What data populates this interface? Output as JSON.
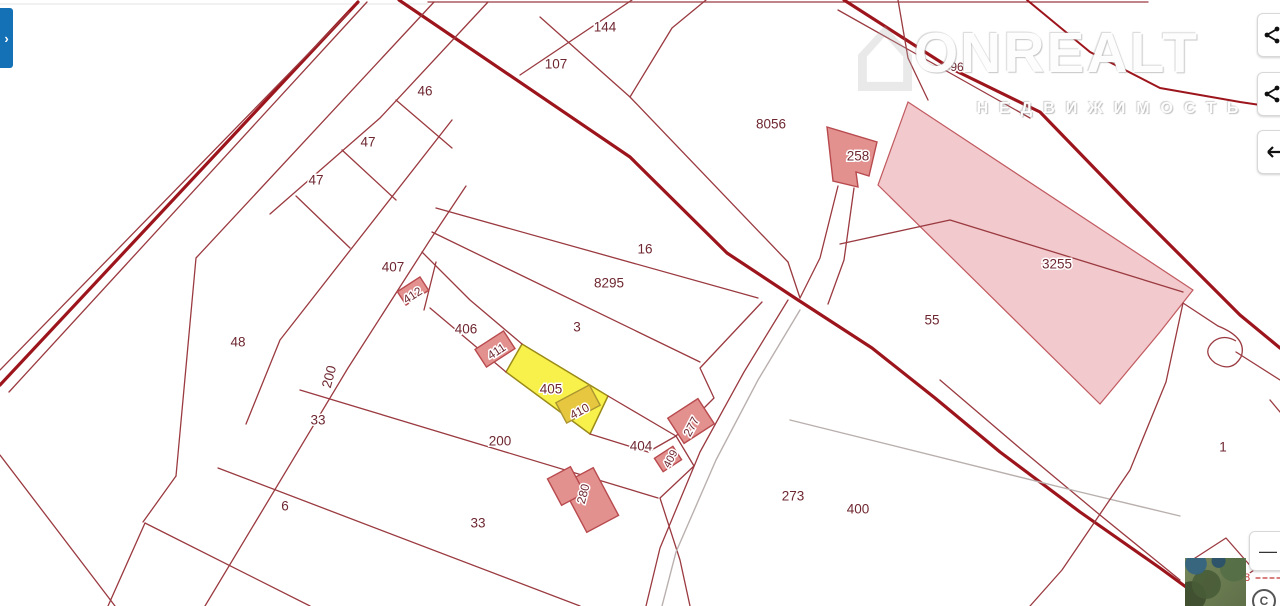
{
  "watermark": {
    "title": "ONREALT",
    "subtitle": "НЕДВИЖИМОСТЬ",
    "house_glyph": "⌂"
  },
  "panel_tab": {
    "glyph": "›"
  },
  "controls": {
    "zoom_out_glyph": "—",
    "side_buttons": [
      {
        "icon": "share-icon"
      },
      {
        "icon": "share-icon"
      },
      {
        "icon": "arrow-left-icon"
      }
    ]
  },
  "attribution": {
    "symbol": "C"
  },
  "map": {
    "colors": {
      "background": "#ffffff",
      "parcel_line": "#9a3a40",
      "road": "#9d151c",
      "gray_line": "#b9b0ae",
      "light_line": "#e3e3e3",
      "label": "#6e2730",
      "label_halo": "#ffffff",
      "building_fill": "#e2918f",
      "building_stroke": "#b84a4e",
      "zone_pink_fill": "#f2c9cc",
      "zone_pink_stroke": "#c05a60",
      "highlight_fill": "#f8f14b",
      "highlight_stroke": "#9a8a18",
      "highlight_building_fill": "#e6c73f",
      "highlight_building_stroke": "#ab9530",
      "dash_red": "#c23434"
    },
    "styles": {
      "road": {
        "c": "#9d151c",
        "w": 3.2
      },
      "road2": {
        "c": "#9d151c",
        "w": 2
      },
      "line": {
        "c": "#9a3a40",
        "w": 1.3
      },
      "gray": {
        "c": "#b9b0ae",
        "w": 1.4
      },
      "light": {
        "c": "#e3e3e3",
        "w": 1
      },
      "dash": {
        "c": "#c23434",
        "w": 1.2,
        "d": "4,3"
      }
    },
    "zones": [
      {
        "name": "zone-3255",
        "pts": [
          [
            908,
            102
          ],
          [
            1193,
            290
          ],
          [
            1160,
            332
          ],
          [
            1100,
            404
          ],
          [
            878,
            185
          ]
        ],
        "fill": "#f2c9cc",
        "stroke": "#c05a60",
        "sw": 1.2
      },
      {
        "name": "parcel-405-highlight",
        "pts": [
          [
            522,
            344
          ],
          [
            608,
            396
          ],
          [
            590,
            434
          ],
          [
            506,
            372
          ]
        ],
        "fill": "#f8f14b",
        "stroke": "#9a8a18",
        "sw": 1.5,
        "interactable": true
      }
    ],
    "lines": [
      {
        "k": "light",
        "pts": [
          [
            0,
            4
          ],
          [
            428,
            4
          ]
        ]
      },
      {
        "k": "line",
        "pts": [
          [
            428,
            2
          ],
          [
            1148,
            2
          ]
        ]
      },
      {
        "k": "road",
        "pts": [
          [
            358,
            2
          ],
          [
            0,
            385
          ]
        ]
      },
      {
        "k": "line",
        "pts": [
          [
            367,
            2
          ],
          [
            9,
            392
          ]
        ]
      },
      {
        "k": "line",
        "pts": [
          [
            349,
            12
          ],
          [
            0,
            370
          ]
        ]
      },
      {
        "k": "road",
        "pts": [
          [
            399,
            0
          ],
          [
            630,
            157
          ],
          [
            727,
            253
          ],
          [
            795,
            298
          ],
          [
            872,
            348
          ],
          [
            935,
            398
          ],
          [
            1000,
            452
          ],
          [
            1080,
            512
          ],
          [
            1160,
            568
          ],
          [
            1212,
            606
          ]
        ]
      },
      {
        "k": "road",
        "pts": [
          [
            844,
            0
          ],
          [
            950,
            68
          ],
          [
            1040,
            112
          ],
          [
            1130,
            205
          ],
          [
            1240,
            315
          ],
          [
            1280,
            348
          ]
        ]
      },
      {
        "k": "line",
        "pts": [
          [
            838,
            10
          ],
          [
            1030,
            118
          ]
        ]
      },
      {
        "k": "road2",
        "pts": [
          [
            1027,
            0
          ],
          [
            1090,
            52
          ],
          [
            1160,
            88
          ],
          [
            1240,
            102
          ],
          [
            1280,
            108
          ]
        ]
      },
      {
        "k": "line",
        "pts": [
          [
            434,
            2
          ],
          [
            196,
            258
          ],
          [
            176,
            476
          ]
        ]
      },
      {
        "k": "line",
        "pts": [
          [
            176,
            476
          ],
          [
            143,
            522
          ]
        ]
      },
      {
        "k": "line",
        "pts": [
          [
            466,
            186
          ],
          [
            430,
            240
          ],
          [
            348,
            368
          ],
          [
            205,
            606
          ]
        ]
      },
      {
        "k": "line",
        "pts": [
          [
            452,
            120
          ],
          [
            280,
            340
          ],
          [
            246,
            424
          ]
        ]
      },
      {
        "k": "line",
        "pts": [
          [
            488,
            2
          ],
          [
            380,
            118
          ],
          [
            270,
            214
          ]
        ]
      },
      {
        "k": "line",
        "pts": [
          [
            632,
            0
          ],
          [
            520,
            75
          ]
        ]
      },
      {
        "k": "line",
        "pts": [
          [
            540,
            17
          ],
          [
            630,
            97
          ],
          [
            672,
            28
          ],
          [
            706,
            0
          ]
        ]
      },
      {
        "k": "line",
        "pts": [
          [
            630,
            97
          ],
          [
            788,
            262
          ]
        ]
      },
      {
        "k": "line",
        "pts": [
          [
            788,
            262
          ],
          [
            800,
            298
          ]
        ]
      },
      {
        "k": "line",
        "pts": [
          [
            838,
            186
          ],
          [
            820,
            258
          ],
          [
            800,
            298
          ]
        ]
      },
      {
        "k": "line",
        "pts": [
          [
            854,
            188
          ],
          [
            844,
            260
          ],
          [
            828,
            304
          ]
        ]
      },
      {
        "k": "line",
        "pts": [
          [
            898,
            0
          ],
          [
            908,
            58
          ],
          [
            928,
            100
          ]
        ]
      },
      {
        "k": "line",
        "pts": [
          [
            840,
            244
          ],
          [
            950,
            220
          ],
          [
            1183,
            292
          ]
        ]
      },
      {
        "k": "line",
        "pts": [
          [
            940,
            380
          ],
          [
            1022,
            450
          ],
          [
            1100,
            515
          ],
          [
            1180,
            580
          ]
        ]
      },
      {
        "k": "line",
        "pts": [
          [
            762,
            302
          ],
          [
            700,
            368
          ],
          [
            714,
            398
          ],
          [
            676,
            436
          ],
          [
            694,
            466
          ],
          [
            660,
            498
          ],
          [
            680,
            560
          ],
          [
            690,
            606
          ]
        ]
      },
      {
        "k": "line",
        "pts": [
          [
            788,
            300
          ],
          [
            744,
            372
          ],
          [
            700,
            452
          ],
          [
            660,
            548
          ],
          [
            646,
            606
          ]
        ]
      },
      {
        "k": "gray",
        "pts": [
          [
            800,
            310
          ],
          [
            758,
            380
          ],
          [
            716,
            460
          ],
          [
            676,
            552
          ],
          [
            662,
            606
          ]
        ]
      },
      {
        "k": "gray",
        "pts": [
          [
            790,
            420
          ],
          [
            1080,
            492
          ],
          [
            1180,
            516
          ]
        ]
      },
      {
        "k": "line",
        "pts": [
          [
            436,
            208
          ],
          [
            758,
            298
          ]
        ]
      },
      {
        "k": "line",
        "pts": [
          [
            432,
            232
          ],
          [
            700,
            362
          ]
        ]
      },
      {
        "k": "line",
        "pts": [
          [
            422,
            252
          ],
          [
            470,
            300
          ],
          [
            522,
            344
          ]
        ]
      },
      {
        "k": "line",
        "pts": [
          [
            608,
            396
          ],
          [
            676,
            436
          ]
        ]
      },
      {
        "k": "line",
        "pts": [
          [
            430,
            308
          ],
          [
            506,
            372
          ]
        ]
      },
      {
        "k": "line",
        "pts": [
          [
            590,
            434
          ],
          [
            648,
            452
          ],
          [
            676,
            436
          ]
        ]
      },
      {
        "k": "line",
        "pts": [
          [
            436,
            262
          ],
          [
            424,
            310
          ]
        ]
      },
      {
        "k": "line",
        "pts": [
          [
            300,
            390
          ],
          [
            658,
            498
          ]
        ]
      },
      {
        "k": "line",
        "pts": [
          [
            218,
            468
          ],
          [
            580,
            606
          ]
        ]
      },
      {
        "k": "line",
        "pts": [
          [
            145,
            523
          ],
          [
            310,
            606
          ]
        ]
      },
      {
        "k": "line",
        "pts": [
          [
            145,
            523
          ],
          [
            108,
            606
          ]
        ]
      },
      {
        "k": "line",
        "pts": [
          [
            0,
            455
          ],
          [
            115,
            606
          ]
        ]
      },
      {
        "k": "line",
        "pts": [
          [
            396,
            100
          ],
          [
            452,
            148
          ]
        ]
      },
      {
        "k": "line",
        "pts": [
          [
            342,
            150
          ],
          [
            396,
            200
          ]
        ]
      },
      {
        "k": "line",
        "pts": [
          [
            296,
            196
          ],
          [
            350,
            248
          ]
        ]
      },
      {
        "k": "line",
        "pts": [
          [
            1183,
            303
          ],
          [
            1166,
            382
          ],
          [
            1130,
            470
          ],
          [
            1062,
            570
          ],
          [
            1030,
            606
          ]
        ]
      },
      {
        "k": "line",
        "pts": [
          [
            1236,
            352
          ],
          [
            1280,
            380
          ]
        ]
      },
      {
        "k": "line",
        "pts": [
          [
            1270,
            400
          ],
          [
            1280,
            412
          ]
        ]
      },
      {
        "k": "line",
        "pts": [
          [
            1192,
            560
          ],
          [
            1226,
            538
          ],
          [
            1254,
            570
          ],
          [
            1220,
            594
          ],
          [
            1192,
            560
          ]
        ]
      },
      {
        "k": "dash",
        "pts": [
          [
            1256,
            578
          ],
          [
            1280,
            578
          ]
        ]
      }
    ],
    "paths": [
      {
        "k": "line",
        "d": "M1183,303 L1218,326 Q1248,338 1241,357 Q1232,373 1215,363 Q1201,352 1214,341 Q1224,334 1236,341"
      }
    ],
    "buildings": [
      {
        "name": "building-412",
        "cx": 413,
        "cy": 291,
        "w": 27,
        "h": 16,
        "rot": -33
      },
      {
        "name": "building-411",
        "cx": 495,
        "cy": 349,
        "w": 34,
        "h": 21,
        "rot": -33
      },
      {
        "name": "building-277",
        "cx": 691,
        "cy": 421,
        "w": 36,
        "h": 30,
        "rot": -33
      },
      {
        "name": "building-409",
        "cx": 668,
        "cy": 459,
        "w": 22,
        "h": 16,
        "rot": -33
      },
      {
        "name": "building-280-a",
        "cx": 590,
        "cy": 500,
        "w": 36,
        "h": 54,
        "rot": -28
      },
      {
        "name": "building-280-b",
        "cx": 566,
        "cy": 486,
        "w": 26,
        "h": 30,
        "rot": -28
      },
      {
        "name": "building-410",
        "cx": 578,
        "cy": 404,
        "w": 38,
        "h": 23,
        "rot": -28,
        "highlight": true
      }
    ],
    "building_polys": [
      {
        "name": "building-258",
        "pts": [
          [
            827,
            127
          ],
          [
            877,
            142
          ],
          [
            869,
            176
          ],
          [
            856,
            172
          ],
          [
            858,
            187
          ],
          [
            833,
            181
          ]
        ]
      }
    ],
    "labels": [
      {
        "t": "144",
        "x": 605,
        "y": 28
      },
      {
        "t": "107",
        "x": 556,
        "y": 65
      },
      {
        "t": "46",
        "x": 425,
        "y": 92
      },
      {
        "t": "47",
        "x": 368,
        "y": 143
      },
      {
        "t": "47",
        "x": 316,
        "y": 181
      },
      {
        "t": "8056",
        "x": 771,
        "y": 125
      },
      {
        "t": "258",
        "x": 858,
        "y": 157
      },
      {
        "t": "96",
        "x": 957,
        "y": 68,
        "s": 12
      },
      {
        "t": "3255",
        "x": 1057,
        "y": 265
      },
      {
        "t": "16",
        "x": 645,
        "y": 250
      },
      {
        "t": "8295",
        "x": 609,
        "y": 284
      },
      {
        "t": "407",
        "x": 393,
        "y": 268
      },
      {
        "t": "412",
        "x": 413,
        "y": 296,
        "r": -33,
        "s": 12
      },
      {
        "t": "406",
        "x": 466,
        "y": 330
      },
      {
        "t": "411",
        "x": 497,
        "y": 352,
        "r": -33,
        "s": 12
      },
      {
        "t": "3",
        "x": 577,
        "y": 328
      },
      {
        "t": "55",
        "x": 932,
        "y": 321
      },
      {
        "t": "48",
        "x": 238,
        "y": 343
      },
      {
        "t": "200",
        "x": 330,
        "y": 377,
        "r": -75
      },
      {
        "t": "33",
        "x": 318,
        "y": 421
      },
      {
        "t": "405",
        "x": 551,
        "y": 390
      },
      {
        "t": "410",
        "x": 580,
        "y": 412,
        "r": -28,
        "s": 12
      },
      {
        "t": "200",
        "x": 500,
        "y": 442
      },
      {
        "t": "404",
        "x": 641,
        "y": 447
      },
      {
        "t": "277",
        "x": 692,
        "y": 427,
        "r": -62,
        "s": 12
      },
      {
        "t": "409",
        "x": 671,
        "y": 459,
        "r": -62,
        "s": 11
      },
      {
        "t": "273",
        "x": 793,
        "y": 497
      },
      {
        "t": "400",
        "x": 858,
        "y": 510
      },
      {
        "t": "280",
        "x": 584,
        "y": 494,
        "r": -75,
        "s": 12
      },
      {
        "t": "6",
        "x": 285,
        "y": 507
      },
      {
        "t": "33",
        "x": 478,
        "y": 524
      },
      {
        "t": "1",
        "x": 1223,
        "y": 448
      },
      {
        "t": "8",
        "x": 1247,
        "y": 578,
        "s": 11,
        "c": "#c23434"
      }
    ]
  }
}
